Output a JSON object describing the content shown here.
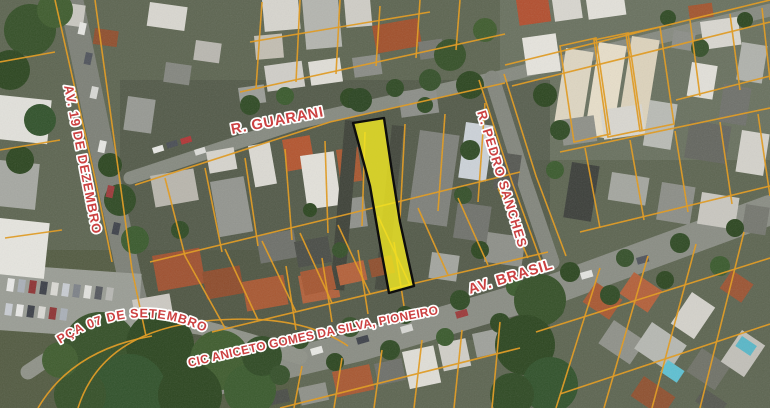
{
  "map": {
    "street_labels": {
      "av_19_de_dezembro": "AV. 19 DE DEZEMBRO",
      "r_guarani": "R. GUARANI",
      "r_pedro_sanches": "R. PEDRO SANCHES",
      "av_brasil": "AV. BRASIL",
      "pca_07_de_setembro": "PÇA 07 DE SETEMBRO",
      "cic_aniceto_gomes_da_silva_pioneiro": "CIC ANICETO GOMES DA SILVA, PIONEIRO"
    },
    "label_style": {
      "fill": "#cc4141",
      "casing": "#ffffff"
    },
    "parcel_line_color": "#e29a1e",
    "highlight": {
      "fill": "#f2ea22",
      "outline": "#0d0d0d"
    }
  }
}
